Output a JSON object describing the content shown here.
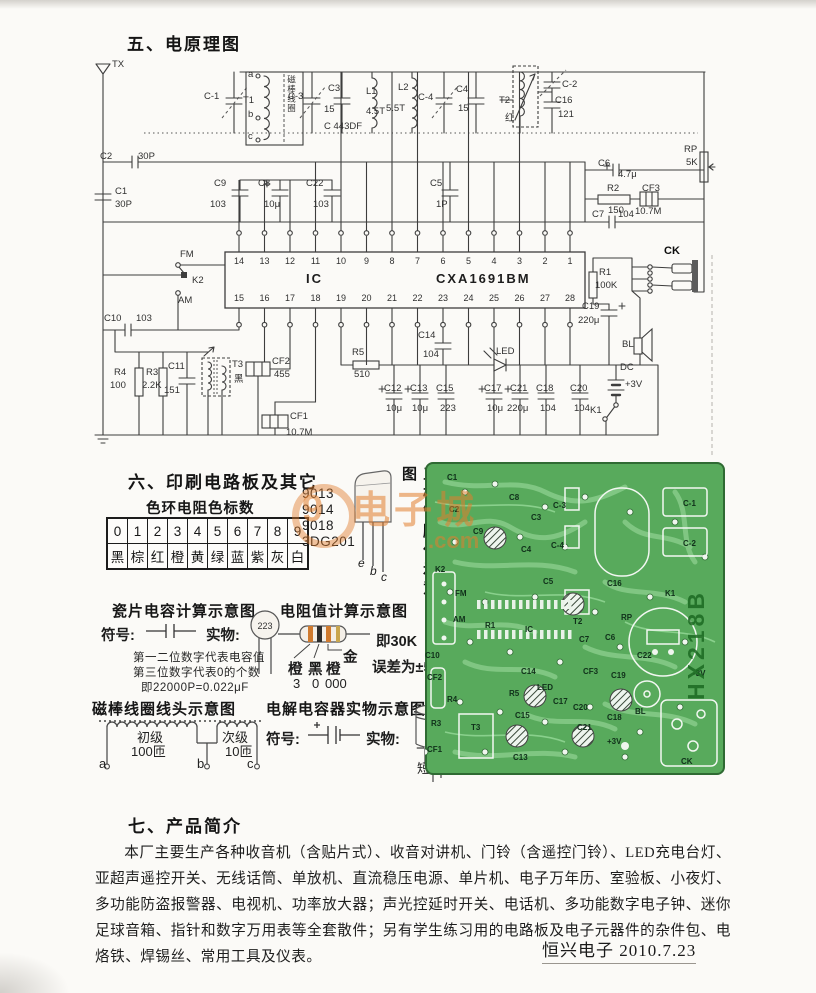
{
  "sections": {
    "s5": {
      "title": "五、电原理图"
    },
    "s6": {
      "title": "六、印刷电路板及其它"
    },
    "s7": {
      "title": "七、产品简介",
      "body": "本厂主要生产各种收音机（含贴片式）、收音对讲机、门铃（含遥控门铃）、LED充电台灯、亚超声遥控开关、无线话筒、单放机、直流稳压电源、单片机、电子万年历、室验板、小夜灯、多功能防盗报警器、电视机、功率放大器；声光控延时开关、电话机、多功能数字电子钟、迷你足球音箱、指针和数字万用表等全套散件；另有学生练习用的电路板及电子元器件的杂件包、电烙铁、焊锡丝、常用工具及仪表。"
    }
  },
  "footer": {
    "text": "恒兴电子 2010.7.23"
  },
  "watermark": {
    "big": "9",
    "text": "电子城",
    "suffix": ".com",
    "color": "#e17d2d"
  },
  "schematic": {
    "ic": {
      "top_pins": [
        "14",
        "13",
        "12",
        "11",
        "10",
        "9",
        "8",
        "7",
        "6",
        "5",
        "4",
        "3",
        "2",
        "1"
      ],
      "bottom_pins": [
        "15",
        "16",
        "17",
        "18",
        "19",
        "20",
        "21",
        "22",
        "23",
        "24",
        "25",
        "26",
        "27",
        "28"
      ]
    },
    "labels": [
      "TX",
      "C-1",
      "T1",
      "a",
      "b",
      "c",
      "磁棒线圈",
      "C-3",
      "C3",
      "15",
      "L1",
      "4.5T",
      "L2",
      "5.5T",
      "C-4",
      "C4",
      "15",
      "T2",
      "红",
      "C-2",
      "C16",
      "121",
      "C 443DF",
      "C2",
      "30P",
      "C1",
      "30P",
      "C9",
      "103",
      "C8",
      "10μ",
      "C22",
      "103",
      "C5",
      "1P",
      "RP",
      "5K",
      "C6",
      "4.7μ",
      "R2",
      "150",
      "CF3",
      "10.7M",
      "C7",
      "104",
      "IC",
      "CXA1691BM",
      "FM",
      "K2",
      "AM",
      "C10",
      "103",
      "R4",
      "100",
      "R3",
      "2.2K",
      "C11",
      "151",
      "T3",
      "黑",
      "CF2",
      "455",
      "CF1",
      "10.7M",
      "R5",
      "510",
      "C14",
      "104",
      "LED",
      "C12",
      "10μ",
      "C13",
      "10μ",
      "C15",
      "223",
      "C17",
      "10μ",
      "C21",
      "220μ",
      "C18",
      "104",
      "C20",
      "104",
      "R1",
      "100K",
      "CK",
      "C19",
      "220μ",
      "BL",
      "DC",
      "+3V",
      "K1"
    ]
  },
  "color_code": {
    "title": "色环电阻色标数",
    "digits": [
      "0",
      "1",
      "2",
      "3",
      "4",
      "5",
      "6",
      "7",
      "8",
      "9"
    ],
    "colors": [
      "黑",
      "棕",
      "红",
      "橙",
      "黄",
      "绿",
      "蓝",
      "紫",
      "灰",
      "白"
    ]
  },
  "transistor": {
    "models": [
      "9013",
      "9014",
      "9018",
      "3DG201"
    ],
    "pins": [
      "e",
      "b",
      "c"
    ],
    "caption": "三极管脚位示意图"
  },
  "ceramic_cap": {
    "title": "瓷片电容计算示意图",
    "symbol_label": "符号:",
    "real_label": "实物:",
    "disc_text": "223",
    "lines": [
      "第一二位数字代表电容值",
      "第三位数字代表0的个数",
      "即22000P=0.022μF"
    ]
  },
  "resistor_calc": {
    "title": "电阻值计算示意图",
    "bands": [
      "橙",
      "黑",
      "橙"
    ],
    "digits": [
      "3",
      "0",
      "000"
    ],
    "gold": "金",
    "result": "即30K",
    "tolerance": "误差为±5%"
  },
  "coil": {
    "title": "磁棒线圈线头示意图",
    "primary": "初级",
    "primary_turns": "100匝",
    "secondary": "次级",
    "secondary_turns": "10匝",
    "terminals": [
      "a",
      "b",
      "c"
    ]
  },
  "electrolytic": {
    "title": "电解电容器实物示意图",
    "symbol_label": "符号:",
    "real_label": "实物:",
    "minus": "−",
    "minus_leg": "短",
    "plus": "+",
    "plus_leg": "长"
  },
  "pcb": {
    "board_color": "#58aa5c",
    "model_vertical": "HX218B",
    "labels": [
      "C1",
      "C2",
      "C9",
      "K2",
      "FM",
      "AM",
      "C3",
      "C4",
      "C5",
      "C-3",
      "C-4",
      "C-1",
      "C-2",
      "C16",
      "K1",
      "R1",
      "IC",
      "T2",
      "C7",
      "C6",
      "RP",
      "C22",
      "CF3",
      "C19",
      "LED",
      "C17",
      "C20",
      "C21",
      "C18",
      "BL",
      "+3V",
      "-3V",
      "R5",
      "C15",
      "C14",
      "CF2",
      "R4",
      "R3",
      "T3",
      "C13",
      "CK",
      "C10",
      "CF1",
      "C8"
    ]
  }
}
